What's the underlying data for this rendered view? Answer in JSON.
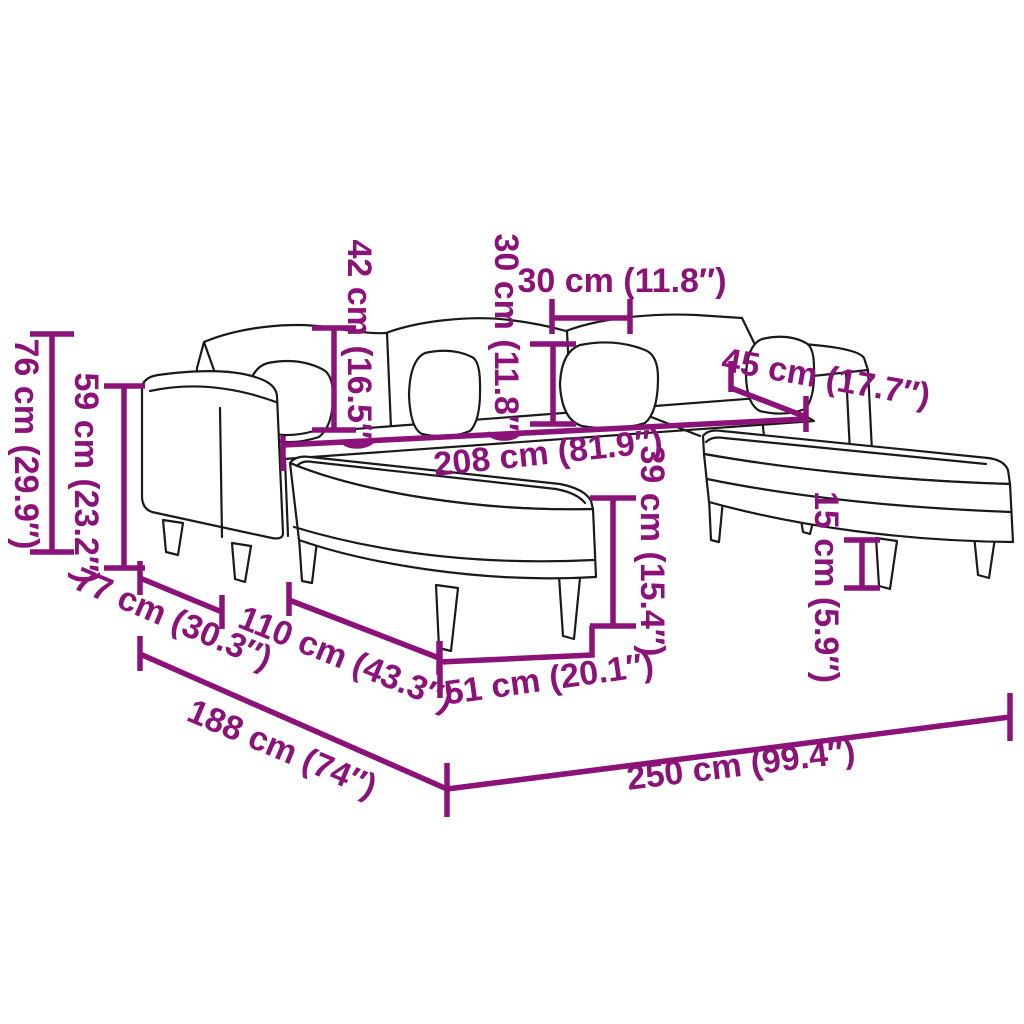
{
  "diagram": {
    "title": "Sofa dimension diagram",
    "item": "U-shaped sofa with two footstools and throw pillows",
    "colors": {
      "dimension": "#8B1278",
      "line": "#1a1a1a",
      "background": "#ffffff"
    },
    "dimensions": [
      {
        "id": "total-height",
        "label": "76 cm (29.9″)",
        "value_cm": 76,
        "value_in": 29.9
      },
      {
        "id": "armrest-height",
        "label": "59 cm (23.2″)",
        "value_cm": 59,
        "value_in": 23.2
      },
      {
        "id": "backrest-height",
        "label": "42 cm (16.5″)",
        "value_cm": 42,
        "value_in": 16.5
      },
      {
        "id": "cushion-height",
        "label": "30 cm (11.8″)",
        "value_cm": 30,
        "value_in": 11.8
      },
      {
        "id": "cushion-width",
        "label": "30 cm (11.8″)",
        "value_cm": 30,
        "value_in": 11.8
      },
      {
        "id": "backrest-depth",
        "label": "45 cm (17.7″)",
        "value_cm": 45,
        "value_in": 17.7
      },
      {
        "id": "seat-width",
        "label": "208 cm (81.9″)",
        "value_cm": 208,
        "value_in": 81.9
      },
      {
        "id": "footstool-height",
        "label": "39 cm (15.4″)",
        "value_cm": 39,
        "value_in": 15.4
      },
      {
        "id": "footstool-depth",
        "label": "51 cm (20.1″)",
        "value_cm": 51,
        "value_in": 20.1
      },
      {
        "id": "leg-height",
        "label": "15 cm (5.9″)",
        "value_cm": 15,
        "value_in": 5.9
      },
      {
        "id": "armrest-depth",
        "label": "77 cm (30.3″)",
        "value_cm": 77,
        "value_in": 30.3
      },
      {
        "id": "footstool-length",
        "label": "110 cm (43.3″)",
        "value_cm": 110,
        "value_in": 43.3
      },
      {
        "id": "total-depth",
        "label": "188 cm (74″)",
        "value_cm": 188,
        "value_in": 74
      },
      {
        "id": "total-width",
        "label": "250 cm (99.4″)",
        "value_cm": 250,
        "value_in": 99.4
      }
    ]
  }
}
